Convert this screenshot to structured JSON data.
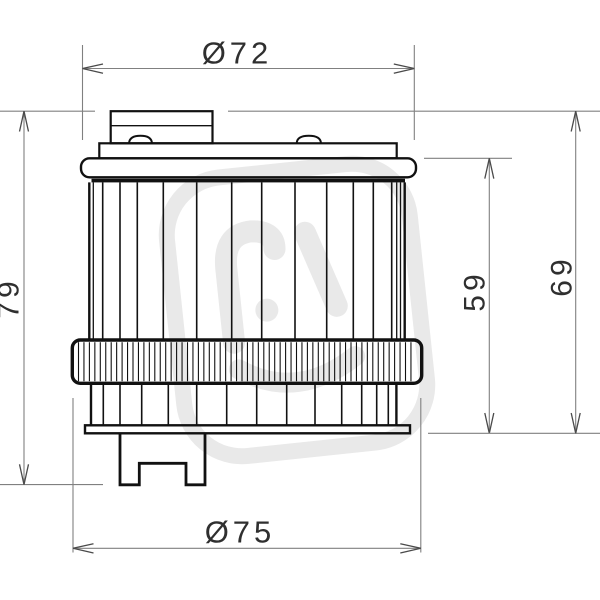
{
  "drawing": {
    "type": "technical-drawing",
    "subject": "oil-filter-side-view",
    "dimension_labels": {
      "top_diameter": "Ø72",
      "bottom_diameter": "Ø75",
      "overall_height": "79",
      "cap_to_base_height": "69",
      "body_height": "59"
    },
    "colors": {
      "object_line": "#111111",
      "dimension_line": "#808080",
      "arrow": "#4a4a4a",
      "dimension_text": "#2f2f2f",
      "watermark": "#e9e9e9",
      "background": "#ffffff"
    }
  }
}
